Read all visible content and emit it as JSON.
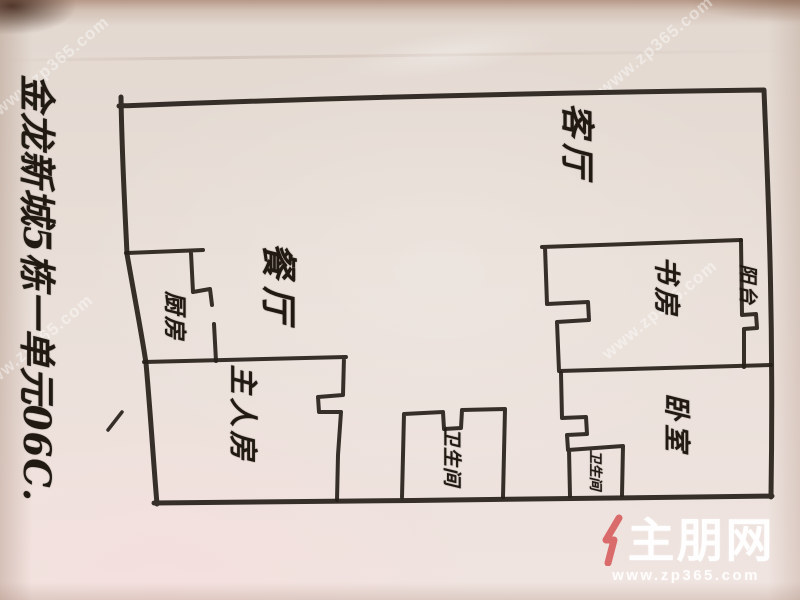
{
  "address_note": "金龙新城5栋一单元06C.",
  "rooms": {
    "living": {
      "label": "客厅"
    },
    "dining": {
      "label": "餐厅"
    },
    "kitchen": {
      "label": "厨房"
    },
    "master_bedroom": {
      "label": "主人房"
    },
    "study": {
      "label": "书房"
    },
    "bedroom": {
      "label": "卧室"
    },
    "balcony": {
      "label": "阳台"
    },
    "bathroom_main": {
      "label": "卫生间"
    },
    "bathroom_small": {
      "label": "卫生间"
    }
  },
  "watermark": {
    "site_name": "住朋网",
    "logo_rest": "主朋网",
    "logo_accent_icon": "red-stroke-icon",
    "url": "www.zp365.com",
    "tile_text": "www.zp365.com",
    "brand_red": "#d96b6b"
  },
  "colors": {
    "ink": "#262019",
    "paper": "#e9dfd8"
  }
}
